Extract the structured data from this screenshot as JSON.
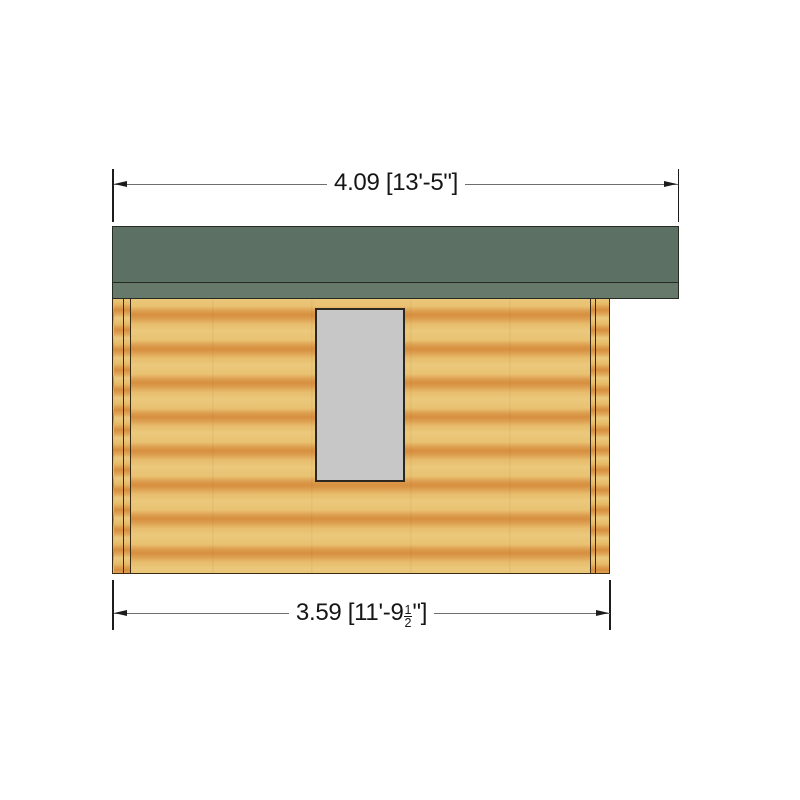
{
  "drawing": {
    "type": "log-cabin-side-elevation",
    "dimensions": {
      "top": {
        "label": "4.09 [13'-5\"]"
      },
      "bottom": {
        "prefix": "3.59 [11'-9",
        "fraction_numerator": "1",
        "fraction_denominator": "2",
        "suffix": "\"]"
      }
    },
    "colors": {
      "roof_green": "#5d7064",
      "roof_fascia_green": "#66796b",
      "wood_light": "#ebc87c",
      "wood_dark": "#d68f3e",
      "window_gray": "#c7c7c7",
      "outline_roof": "#252a22",
      "outline_brown": "#3c2a14",
      "outline_window": "#2c2820",
      "outline_dark": "#1c1c1c",
      "dimension_line": "#6f6f6f",
      "text": "#161616"
    }
  }
}
